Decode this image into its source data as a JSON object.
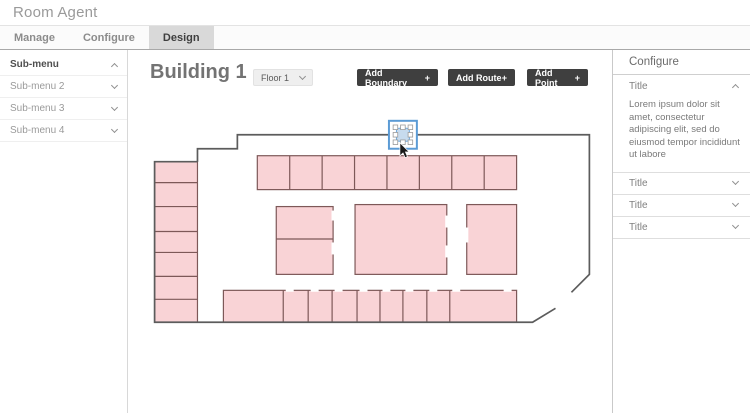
{
  "window": {
    "title": "Room Agent"
  },
  "tabs": [
    {
      "label": "Manage"
    },
    {
      "label": "Configure"
    },
    {
      "label": "Design"
    }
  ],
  "active_tab": "Design",
  "sidebar": {
    "items": [
      {
        "label": "Sub-menu",
        "state": "expanded"
      },
      {
        "label": "Sub-menu 2",
        "state": "collapsed"
      },
      {
        "label": "Sub-menu 3",
        "state": "collapsed"
      },
      {
        "label": "Sub-menu 4",
        "state": "collapsed"
      }
    ]
  },
  "canvas": {
    "title": "Building 1",
    "floor_dropdown": {
      "value": "Floor 1"
    },
    "buttons": [
      {
        "label": "Add Boundary",
        "plus": "+"
      },
      {
        "label": "Add Route",
        "plus": "+"
      },
      {
        "label": "Add Point",
        "plus": "+"
      }
    ]
  },
  "config_panel": {
    "title": "Configure",
    "expanded_section": {
      "label": "Title",
      "body": "Lorem ipsum dolor sit amet, consectetur adipiscing elit, sed do eiusmod tempor incididunt ut labore"
    },
    "collapsed_sections": [
      {
        "label": "Title"
      },
      {
        "label": "Title"
      },
      {
        "label": "Title"
      }
    ]
  },
  "colors": {
    "selection_accent": "#5b9bd5",
    "room_fill": "#f9d3d6",
    "room_stroke": "#7d5858",
    "wall_stroke": "#5c5c5c",
    "button_bg": "#3f3f3f",
    "active_tab_bg": "#d9d9d9"
  }
}
